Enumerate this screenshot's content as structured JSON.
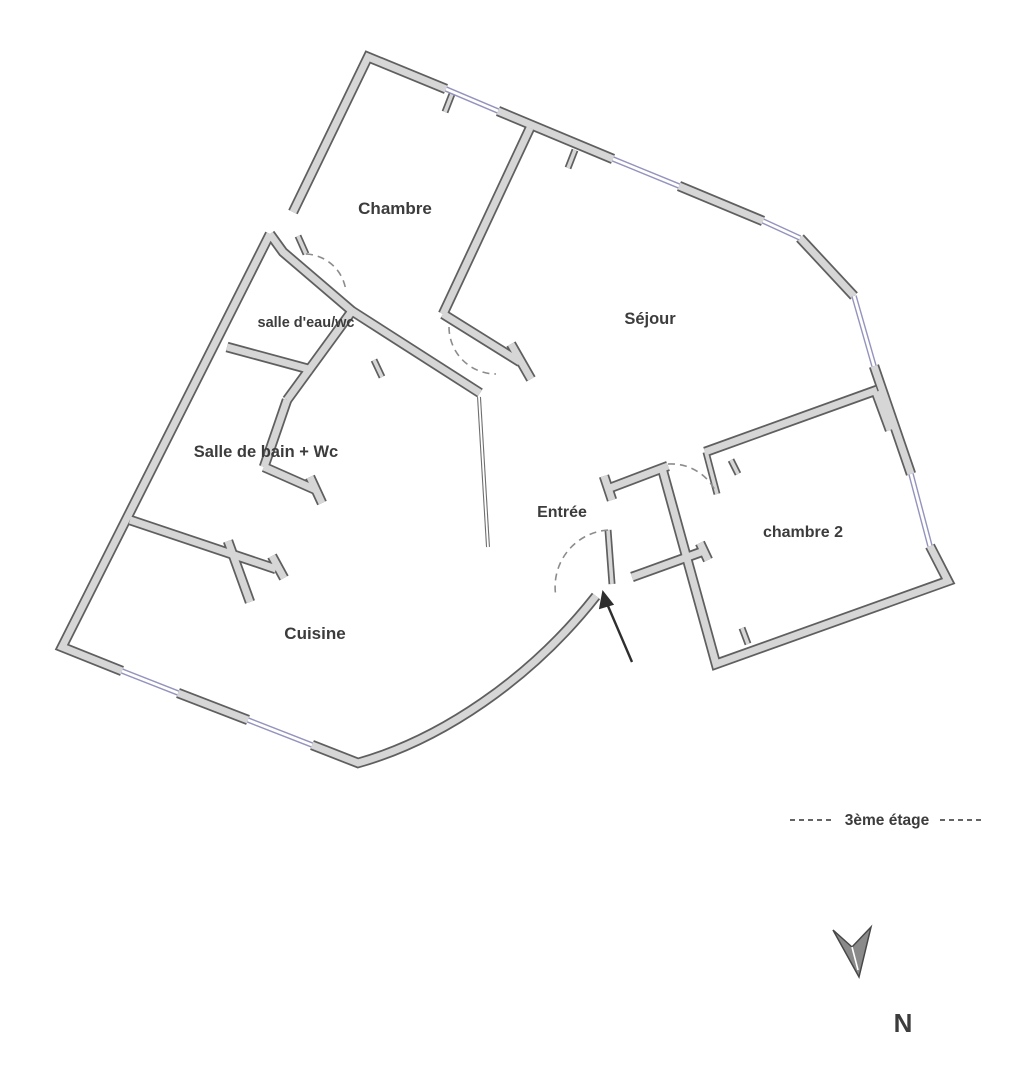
{
  "floorplan": {
    "rooms": [
      {
        "id": "chambre",
        "label": "Chambre"
      },
      {
        "id": "sejour",
        "label": "Séjour"
      },
      {
        "id": "salle-deau-wc",
        "label": "salle d'eau/wc"
      },
      {
        "id": "salle-de-bain-wc",
        "label": "Salle de bain + Wc"
      },
      {
        "id": "cuisine",
        "label": "Cuisine"
      },
      {
        "id": "entree",
        "label": "Entrée"
      },
      {
        "id": "chambre-2",
        "label": "chambre 2"
      }
    ],
    "legend": {
      "floor_label": "3ème étage"
    },
    "compass": {
      "north_label": "N"
    },
    "icons": [
      "entrance-arrow-icon",
      "compass-north-icon"
    ],
    "colors": {
      "wall_outline": "#5f5f5f",
      "wall_fill": "#d6d6d6",
      "window_color": "#9393bd",
      "text_color": "#3c3c3c",
      "arc_color": "#8c8c8c",
      "arrow_color": "#2e2e2e"
    }
  }
}
